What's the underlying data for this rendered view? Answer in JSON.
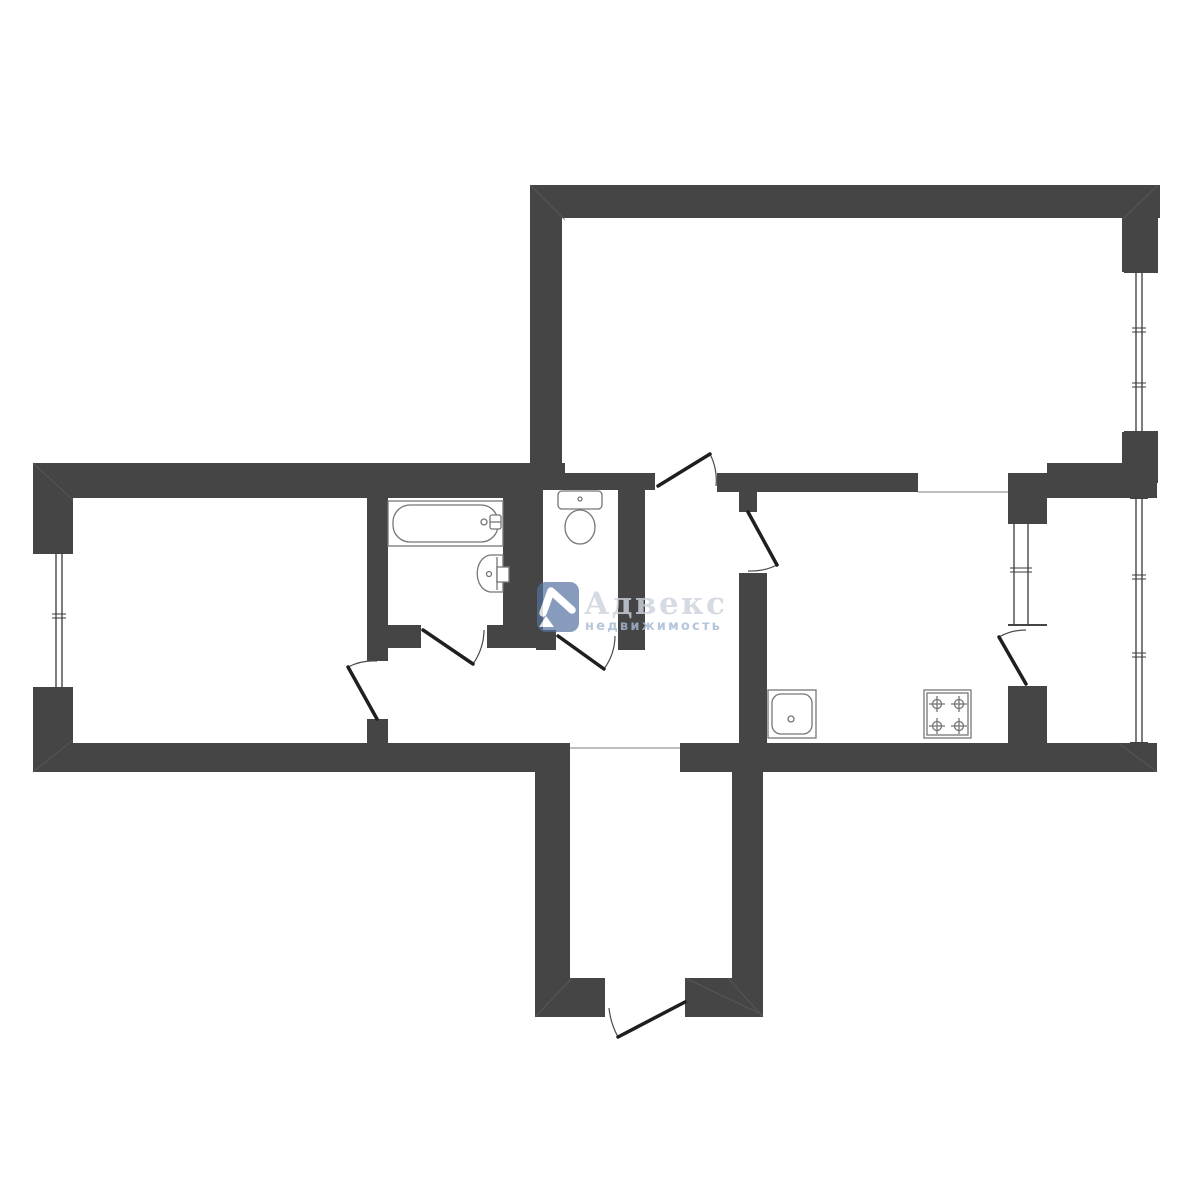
{
  "watermark": {
    "brand": "Адвекс",
    "subtitle": "недвижимость",
    "logo_color": "#53719f",
    "brand_color": "#ccd3dd",
    "subtitle_color": "#a7bad2"
  },
  "plan": {
    "canvas": {
      "w": 1200,
      "h": 1200
    },
    "colors": {
      "wall": "#454545",
      "bg": "#ffffff",
      "fixture": "#767676",
      "door_leaf": "#1f1f1f",
      "door_arc": "#4a4a4a",
      "boundary": "#a8a8a8",
      "miter": "#5f5f5f",
      "glaze": "#3a3a3a"
    },
    "walls": [
      {
        "name": "living-room-top-wall",
        "r": [
          530,
          185,
          630,
          33
        ]
      },
      {
        "name": "living-room-left-wall",
        "r": [
          530,
          185,
          32,
          305
        ]
      },
      {
        "name": "living-room-right-wall-above-window",
        "r": [
          1122,
          185,
          36,
          87
        ]
      },
      {
        "name": "living-room-right-wall-below-window",
        "r": [
          1122,
          432,
          36,
          51
        ]
      },
      {
        "name": "balcony-top-wall",
        "r": [
          1047,
          463,
          110,
          35
        ]
      },
      {
        "name": "living-room-bottom-wall-left",
        "r": [
          562,
          473,
          93,
          17
        ]
      },
      {
        "name": "living-room-bottom-wall-right",
        "r": [
          717,
          473,
          201,
          19
        ]
      },
      {
        "name": "kitchen-right-wall-top-block",
        "r": [
          1008,
          473,
          39,
          50
        ]
      },
      {
        "name": "left-wing-top-wall",
        "r": [
          33,
          463,
          510,
          35
        ]
      },
      {
        "name": "wc-top-junction",
        "r": [
          543,
          463,
          22,
          25
        ]
      },
      {
        "name": "bedroom-left-wall-above-window",
        "r": [
          33,
          463,
          40,
          90
        ]
      },
      {
        "name": "bedroom-left-wall-below-window",
        "r": [
          33,
          688,
          40,
          84
        ]
      },
      {
        "name": "left-wing-bottom-wall",
        "r": [
          33,
          743,
          537,
          29
        ]
      },
      {
        "name": "bedroom-right-wall-upper",
        "r": [
          367,
          494,
          21,
          167
        ]
      },
      {
        "name": "bedroom-right-wall-lower",
        "r": [
          367,
          719,
          21,
          24
        ]
      },
      {
        "name": "bathroom-wc-divider-wall",
        "r": [
          503,
          498,
          40,
          150
        ]
      },
      {
        "name": "bathroom-bottom-wall-left",
        "r": [
          388,
          625,
          33,
          23
        ]
      },
      {
        "name": "bathroom-bottom-wall-right",
        "r": [
          487,
          625,
          16,
          23
        ]
      },
      {
        "name": "wc-bottom-wall-left",
        "r": [
          536,
          630,
          20,
          20
        ]
      },
      {
        "name": "wc-right-wall",
        "r": [
          618,
          488,
          27,
          162
        ]
      },
      {
        "name": "kitchen-door-post",
        "r": [
          739,
          473,
          18,
          39
        ]
      },
      {
        "name": "kitchen-left-wall-lower",
        "r": [
          739,
          573,
          28,
          170
        ]
      },
      {
        "name": "kitchen-right-wall-bottom-block",
        "r": [
          1008,
          686,
          39,
          57
        ]
      },
      {
        "name": "kitchen-balcony-bottom-wall",
        "r": [
          680,
          743,
          477,
          29
        ]
      },
      {
        "name": "vestibule-left-wall",
        "r": [
          535,
          772,
          35,
          245
        ]
      },
      {
        "name": "vestibule-right-wall",
        "r": [
          732,
          772,
          31,
          245
        ]
      },
      {
        "name": "vestibule-bottom-wall-left",
        "r": [
          535,
          978,
          70,
          39
        ]
      },
      {
        "name": "vestibule-bottom-wall-right",
        "r": [
          685,
          978,
          78,
          39
        ]
      }
    ],
    "boundary_lines": [
      {
        "name": "vestibule-threshold-line",
        "l": [
          570,
          748,
          680,
          748
        ]
      },
      {
        "name": "kitchen-living-open-boundary",
        "l": [
          918,
          492,
          1008,
          492
        ]
      }
    ],
    "miter_lines": [
      {
        "l": [
          530,
          185,
          565,
          220
        ]
      },
      {
        "l": [
          1158,
          185,
          1122,
          220
        ]
      },
      {
        "l": [
          33,
          463,
          73,
          500
        ]
      },
      {
        "l": [
          33,
          772,
          73,
          740
        ]
      },
      {
        "l": [
          535,
          1017,
          572,
          978
        ]
      },
      {
        "l": [
          763,
          1017,
          728,
          978
        ]
      },
      {
        "l": [
          1157,
          772,
          1118,
          743
        ]
      },
      {
        "l": [
          685,
          978,
          763,
          1015
        ]
      }
    ],
    "windows": [
      {
        "name": "bedroom-window",
        "rect": [
          33,
          553,
          40,
          135
        ],
        "glaze": [
          56,
          62
        ],
        "ticks": [
          616
        ]
      },
      {
        "name": "living-room-window",
        "rect": [
          1124,
          272,
          34,
          160
        ],
        "glaze": [
          1136,
          1142
        ],
        "ticks": [
          330,
          385
        ]
      },
      {
        "name": "kitchen-window",
        "rect": [
          1008,
          523,
          39,
          102
        ],
        "glaze": [
          1014,
          1028
        ],
        "ticks": [
          570
        ]
      },
      {
        "name": "balcony-window",
        "rect": [
          1130,
          498,
          18,
          245
        ],
        "glaze": [
          1136,
          1142
        ],
        "ticks": [
          577,
          655
        ]
      }
    ],
    "doors": [
      {
        "name": "living-room-door",
        "leaf": [
          658,
          486,
          710,
          454
        ],
        "arc": "M 716 486 A 58 58 0 0 0 710 454"
      },
      {
        "name": "bedroom-door",
        "leaf": [
          377,
          719,
          348,
          667
        ],
        "arc": "M 377 661 A 58 58 0 0 0 348 667"
      },
      {
        "name": "bathroom-door",
        "leaf": [
          423,
          630,
          473,
          664
        ],
        "arc": "M 484 630 A 61 61 0 0 1 473 664"
      },
      {
        "name": "wc-door",
        "leaf": [
          558,
          636,
          604,
          669
        ],
        "arc": "M 615 636 A 57 57 0 0 1 604 669"
      },
      {
        "name": "kitchen-door",
        "leaf": [
          748,
          512,
          777,
          565
        ],
        "arc": "M 748 571 A 59 59 0 0 0 777 565"
      },
      {
        "name": "balcony-door",
        "leaf": [
          1026,
          684,
          999,
          637
        ],
        "arc": "M 1026 630 A 54 54 0 0 0 999 637"
      },
      {
        "name": "entrance-door",
        "leaf": [
          685,
          1002,
          618,
          1037
        ],
        "arc": "M 609 1008 A 76 76 0 0 0 618 1037"
      }
    ],
    "fixtures": [
      {
        "name": "bathtub",
        "shapes": [
          {
            "t": "rect",
            "x": 388,
            "y": 501,
            "w": 115,
            "h": 45
          },
          {
            "t": "rect",
            "x": 393,
            "y": 505,
            "w": 105,
            "h": 37,
            "rx": 17
          },
          {
            "t": "circle",
            "cx": 484,
            "cy": 522,
            "r": 3
          },
          {
            "t": "rect",
            "x": 490,
            "y": 515,
            "w": 11,
            "h": 14,
            "rx": 2
          },
          {
            "t": "line",
            "x1": 490,
            "y1": 522,
            "x2": 501,
            "y2": 522
          }
        ]
      },
      {
        "name": "bathroom-sink",
        "shapes": [
          {
            "t": "path",
            "d": "M 503 555 L 490 555 C 473 558 473 589 490 592 L 503 592 Z"
          },
          {
            "t": "line",
            "x1": 497,
            "y1": 557,
            "x2": 497,
            "y2": 590
          },
          {
            "t": "rect",
            "x": 497,
            "y": 567,
            "w": 12,
            "h": 15
          },
          {
            "t": "circle",
            "cx": 489,
            "cy": 574,
            "r": 2.5
          }
        ]
      },
      {
        "name": "toilet",
        "shapes": [
          {
            "t": "rect",
            "x": 558,
            "y": 491,
            "w": 44,
            "h": 18,
            "rx": 4
          },
          {
            "t": "circle",
            "cx": 580,
            "cy": 499,
            "r": 2
          },
          {
            "t": "ellipse",
            "cx": 580,
            "cy": 527,
            "rx": 15,
            "ry": 17
          }
        ]
      },
      {
        "name": "kitchen-sink",
        "shapes": [
          {
            "t": "rect",
            "x": 768,
            "y": 690,
            "w": 48,
            "h": 48
          },
          {
            "t": "rect",
            "x": 772,
            "y": 694,
            "w": 40,
            "h": 40,
            "rx": 9
          },
          {
            "t": "circle",
            "cx": 791,
            "cy": 719,
            "r": 3
          }
        ]
      },
      {
        "name": "stove",
        "shapes": [
          {
            "t": "rect",
            "x": 924,
            "y": 690,
            "w": 47,
            "h": 48
          },
          {
            "t": "rect",
            "x": 927,
            "y": 693,
            "w": 41,
            "h": 42
          },
          {
            "t": "burner",
            "cx": 937,
            "cy": 704
          },
          {
            "t": "burner",
            "cx": 959,
            "cy": 704
          },
          {
            "t": "burner",
            "cx": 937,
            "cy": 726
          },
          {
            "t": "burner",
            "cx": 959,
            "cy": 726
          }
        ]
      }
    ]
  }
}
